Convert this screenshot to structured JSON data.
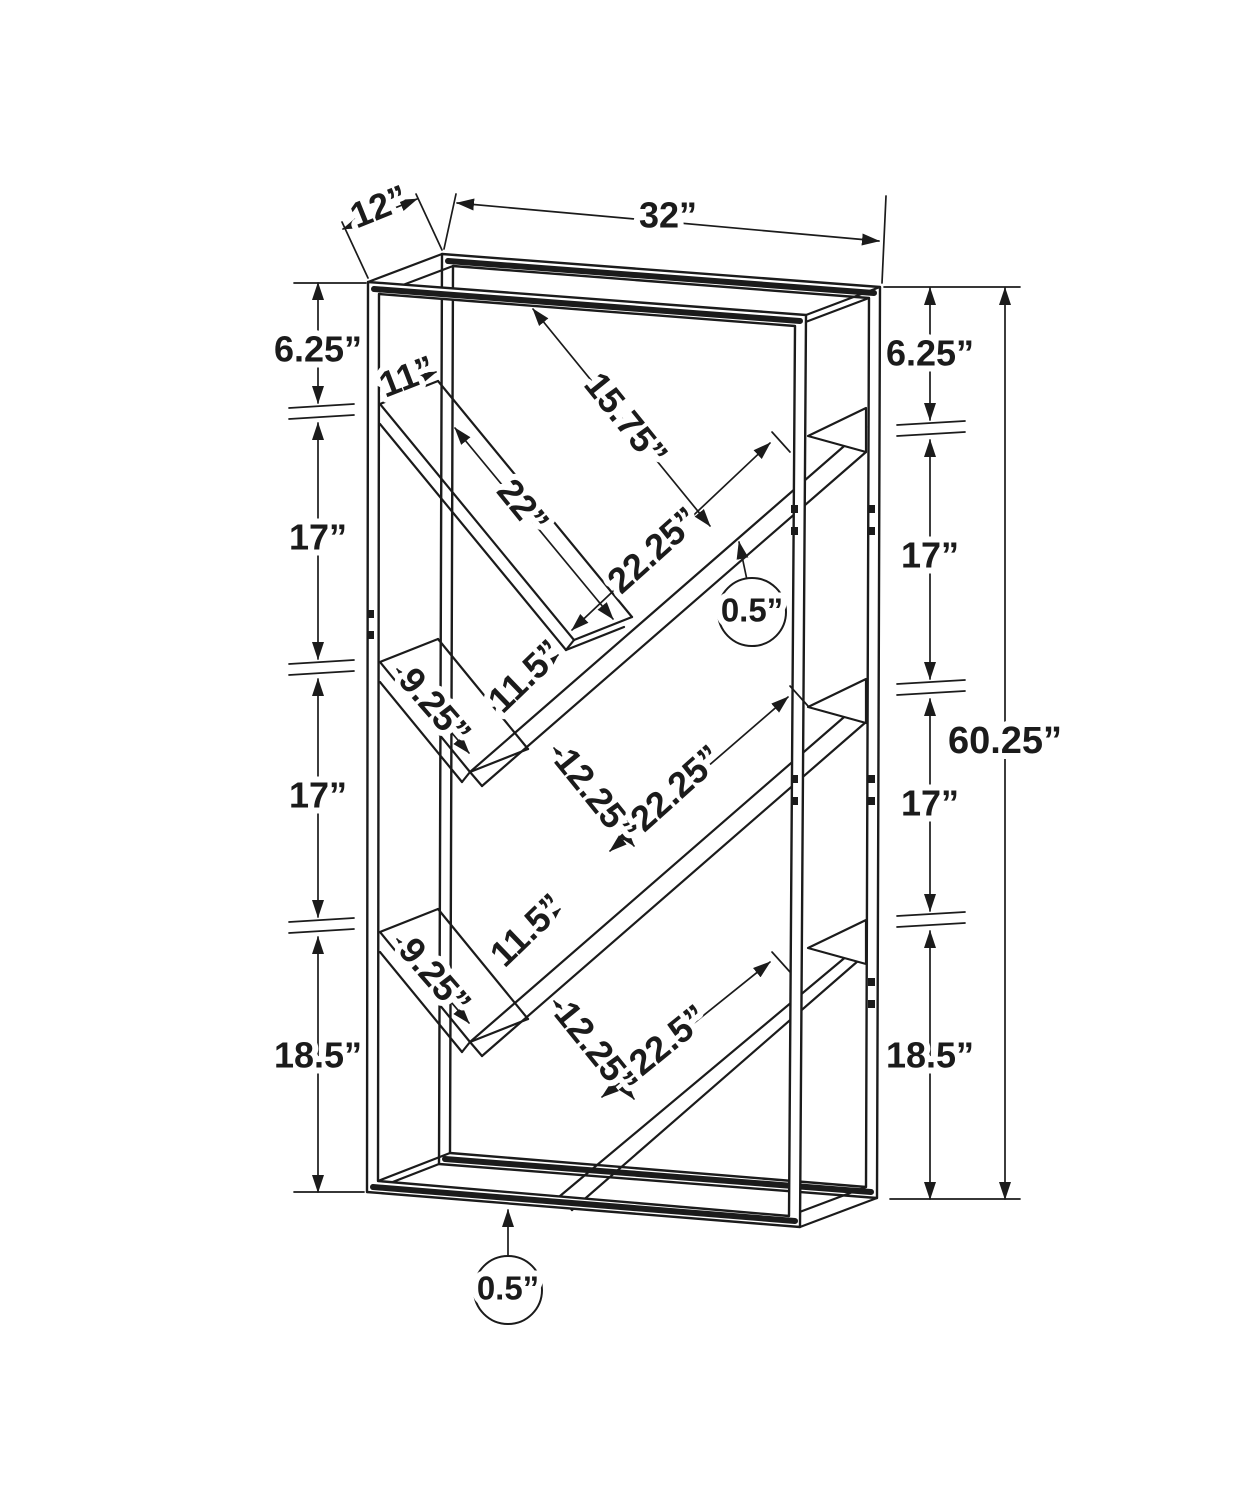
{
  "dims": {
    "top": {
      "depth": "12”",
      "width": "32”"
    },
    "left": [
      "6.25”",
      "17”",
      "17”",
      "18.5”"
    ],
    "right": [
      "6.25”",
      "17”",
      "17”",
      "18.5”"
    ],
    "overall_height": "60.25”",
    "interior": {
      "shelf_depth": "11”",
      "top_clearance": "15.75”",
      "top_shelf_length": "22”",
      "upper_long_shelf": "22.25”",
      "shelf_thickness": "0.5”",
      "upper_gap": "11.5”",
      "middle_short_shelf": "9.25”",
      "middle_gap": "12.25”",
      "middle_long_shelf": "22.25”",
      "lower_short_shelf": "9.25”",
      "lower_gap": "11.5”",
      "lower_gap2": "12.25”",
      "bottom_long_shelf": "22.5”",
      "base_thickness": "0.5”"
    }
  }
}
